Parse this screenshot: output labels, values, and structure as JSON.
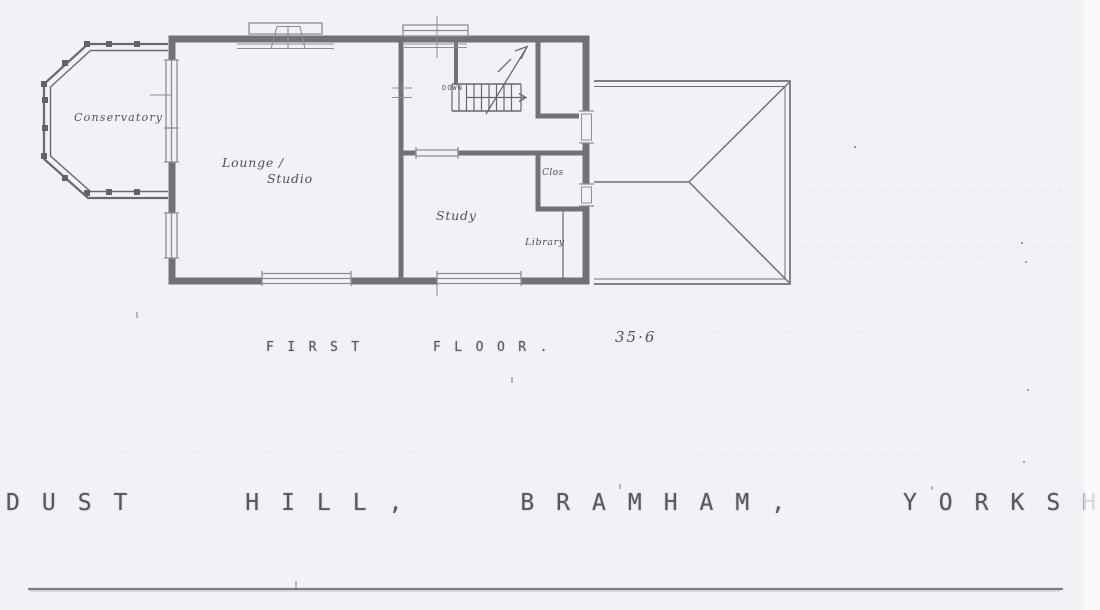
{
  "colors": {
    "paper": "#f2f2f6",
    "ink": "#63636d",
    "label_ink": "#4f4f59"
  },
  "plan": {
    "drawing_type": "architectural floor plan (scanned hand drawing)",
    "room_labels": {
      "conservatory": "Conservatory",
      "lounge_line1": "Lounge /",
      "lounge_line2": "Studio",
      "study": "Study",
      "closet": "Clos",
      "library": "Library"
    },
    "stairs": {
      "direction_label": "DOWN"
    },
    "caption": {
      "title": "FIRST FLOOR.",
      "dimension": "35·6"
    }
  },
  "footer": {
    "address": "DUST HILL, BRAMHAM, YORKSH"
  }
}
